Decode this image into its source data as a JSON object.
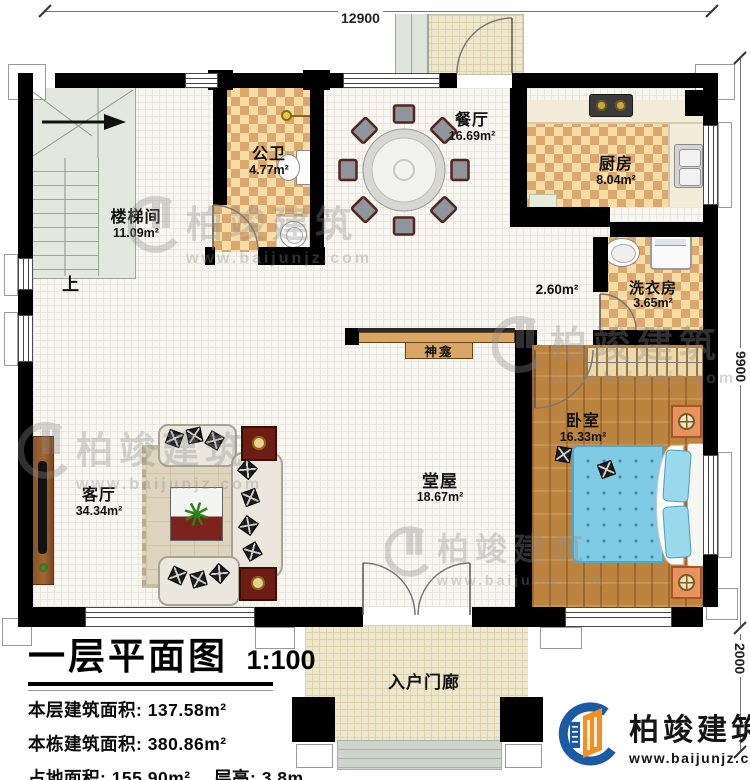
{
  "dimensions": {
    "width_top": "12900",
    "height_main": "9900",
    "height_porch": "2000"
  },
  "rooms": {
    "stairwell": {
      "name": "楼梯间",
      "area": "11.09m²"
    },
    "bathroom": {
      "name": "公卫",
      "area": "4.77m²"
    },
    "dining": {
      "name": "餐厅",
      "area": "16.69m²"
    },
    "kitchen": {
      "name": "厨房",
      "area": "8.04m²"
    },
    "laundry": {
      "name": "洗衣房",
      "area": "3.65m²"
    },
    "corridor": {
      "area": "2.60m²"
    },
    "bedroom": {
      "name": "卧室",
      "area": "16.33m²"
    },
    "hall": {
      "name": "堂屋",
      "area": "18.67m²"
    },
    "living": {
      "name": "客厅",
      "area": "34.34m²"
    },
    "porch": {
      "name": "入户门廊"
    }
  },
  "labels": {
    "shrine": "神龛",
    "stairs_up": "上"
  },
  "title_block": {
    "title": "一层平面图",
    "scale": "1:100",
    "lines": [
      {
        "label": "本层建筑面积:",
        "value": "137.58m²"
      },
      {
        "label": "本栋建筑面积:",
        "value": "380.86m²"
      },
      {
        "label": "占地面积:",
        "value": "155.90m²",
        "label2": "层高:",
        "value2": "3.8m"
      }
    ]
  },
  "brand": {
    "name": "柏竣建筑",
    "url": "www.baijunjz.com"
  },
  "watermark": {
    "name": "柏竣建筑",
    "url": "www.baijunjz.com"
  },
  "colors": {
    "wall": "#000000",
    "checker_light": "#f6dda6",
    "checker_dark": "#dba76d",
    "wood_floor": "#bd8440",
    "bed_blue": "#7ecbe3",
    "brand_blue": "#1b5aa5",
    "brand_orange": "#f29022"
  }
}
